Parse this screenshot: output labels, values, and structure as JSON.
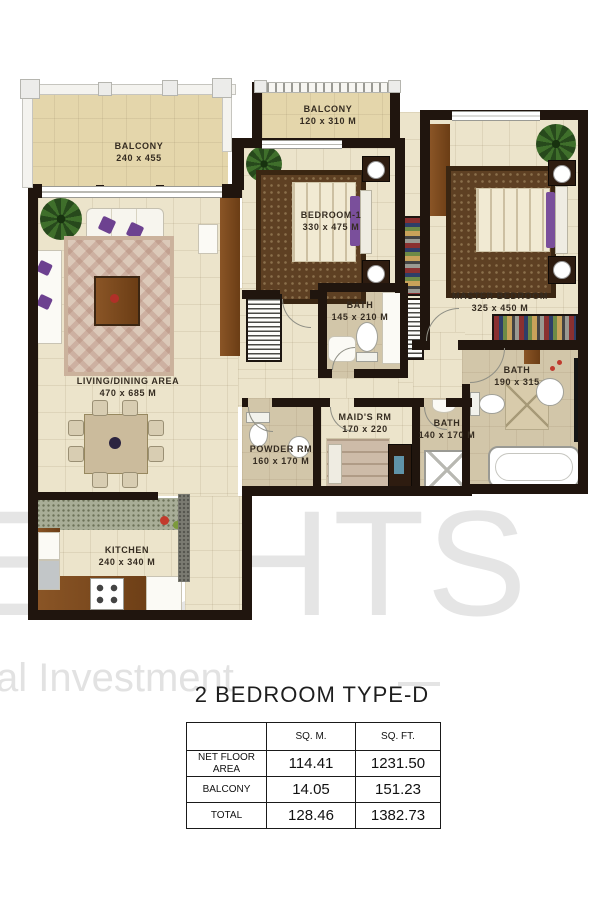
{
  "watermark": {
    "big": "HEIGHTS",
    "small": "al Investment"
  },
  "title": "2 BEDROOM TYPE-D",
  "rooms": {
    "balcony_main": {
      "name": "BALCONY",
      "dims": "240 x 455"
    },
    "balcony_small": {
      "name": "BALCONY",
      "dims": "120 x 310 M"
    },
    "bedroom1": {
      "name": "BEDROOM-1",
      "dims": "330 x 475 M"
    },
    "master": {
      "name": "MASTER BEDROOM",
      "dims": "325 x 450 M"
    },
    "bath1": {
      "name": "BATH",
      "dims": "145 x 210 M"
    },
    "master_bath": {
      "name": "BATH",
      "dims": "190 x 315"
    },
    "living": {
      "name": "LIVING/DINING AREA",
      "dims": "470 x 685 M"
    },
    "powder": {
      "name": "POWDER RM",
      "dims": "160 x 170 M"
    },
    "maids": {
      "name": "MAID'S RM",
      "dims": "170 x 220"
    },
    "maid_bath": {
      "name": "BATH",
      "dims": "140 x 170 M"
    },
    "kitchen": {
      "name": "KITCHEN",
      "dims": "240 x 340 M"
    }
  },
  "table": {
    "col_headers": [
      "SQ. M.",
      "SQ. FT."
    ],
    "rows": [
      {
        "label": "NET FLOOR AREA",
        "sqm": "114.41",
        "sqft": "1231.50"
      },
      {
        "label": "BALCONY",
        "sqm": "14.05",
        "sqft": "151.23"
      },
      {
        "label": "TOTAL",
        "sqm": "128.46",
        "sqft": "1382.73"
      }
    ]
  }
}
